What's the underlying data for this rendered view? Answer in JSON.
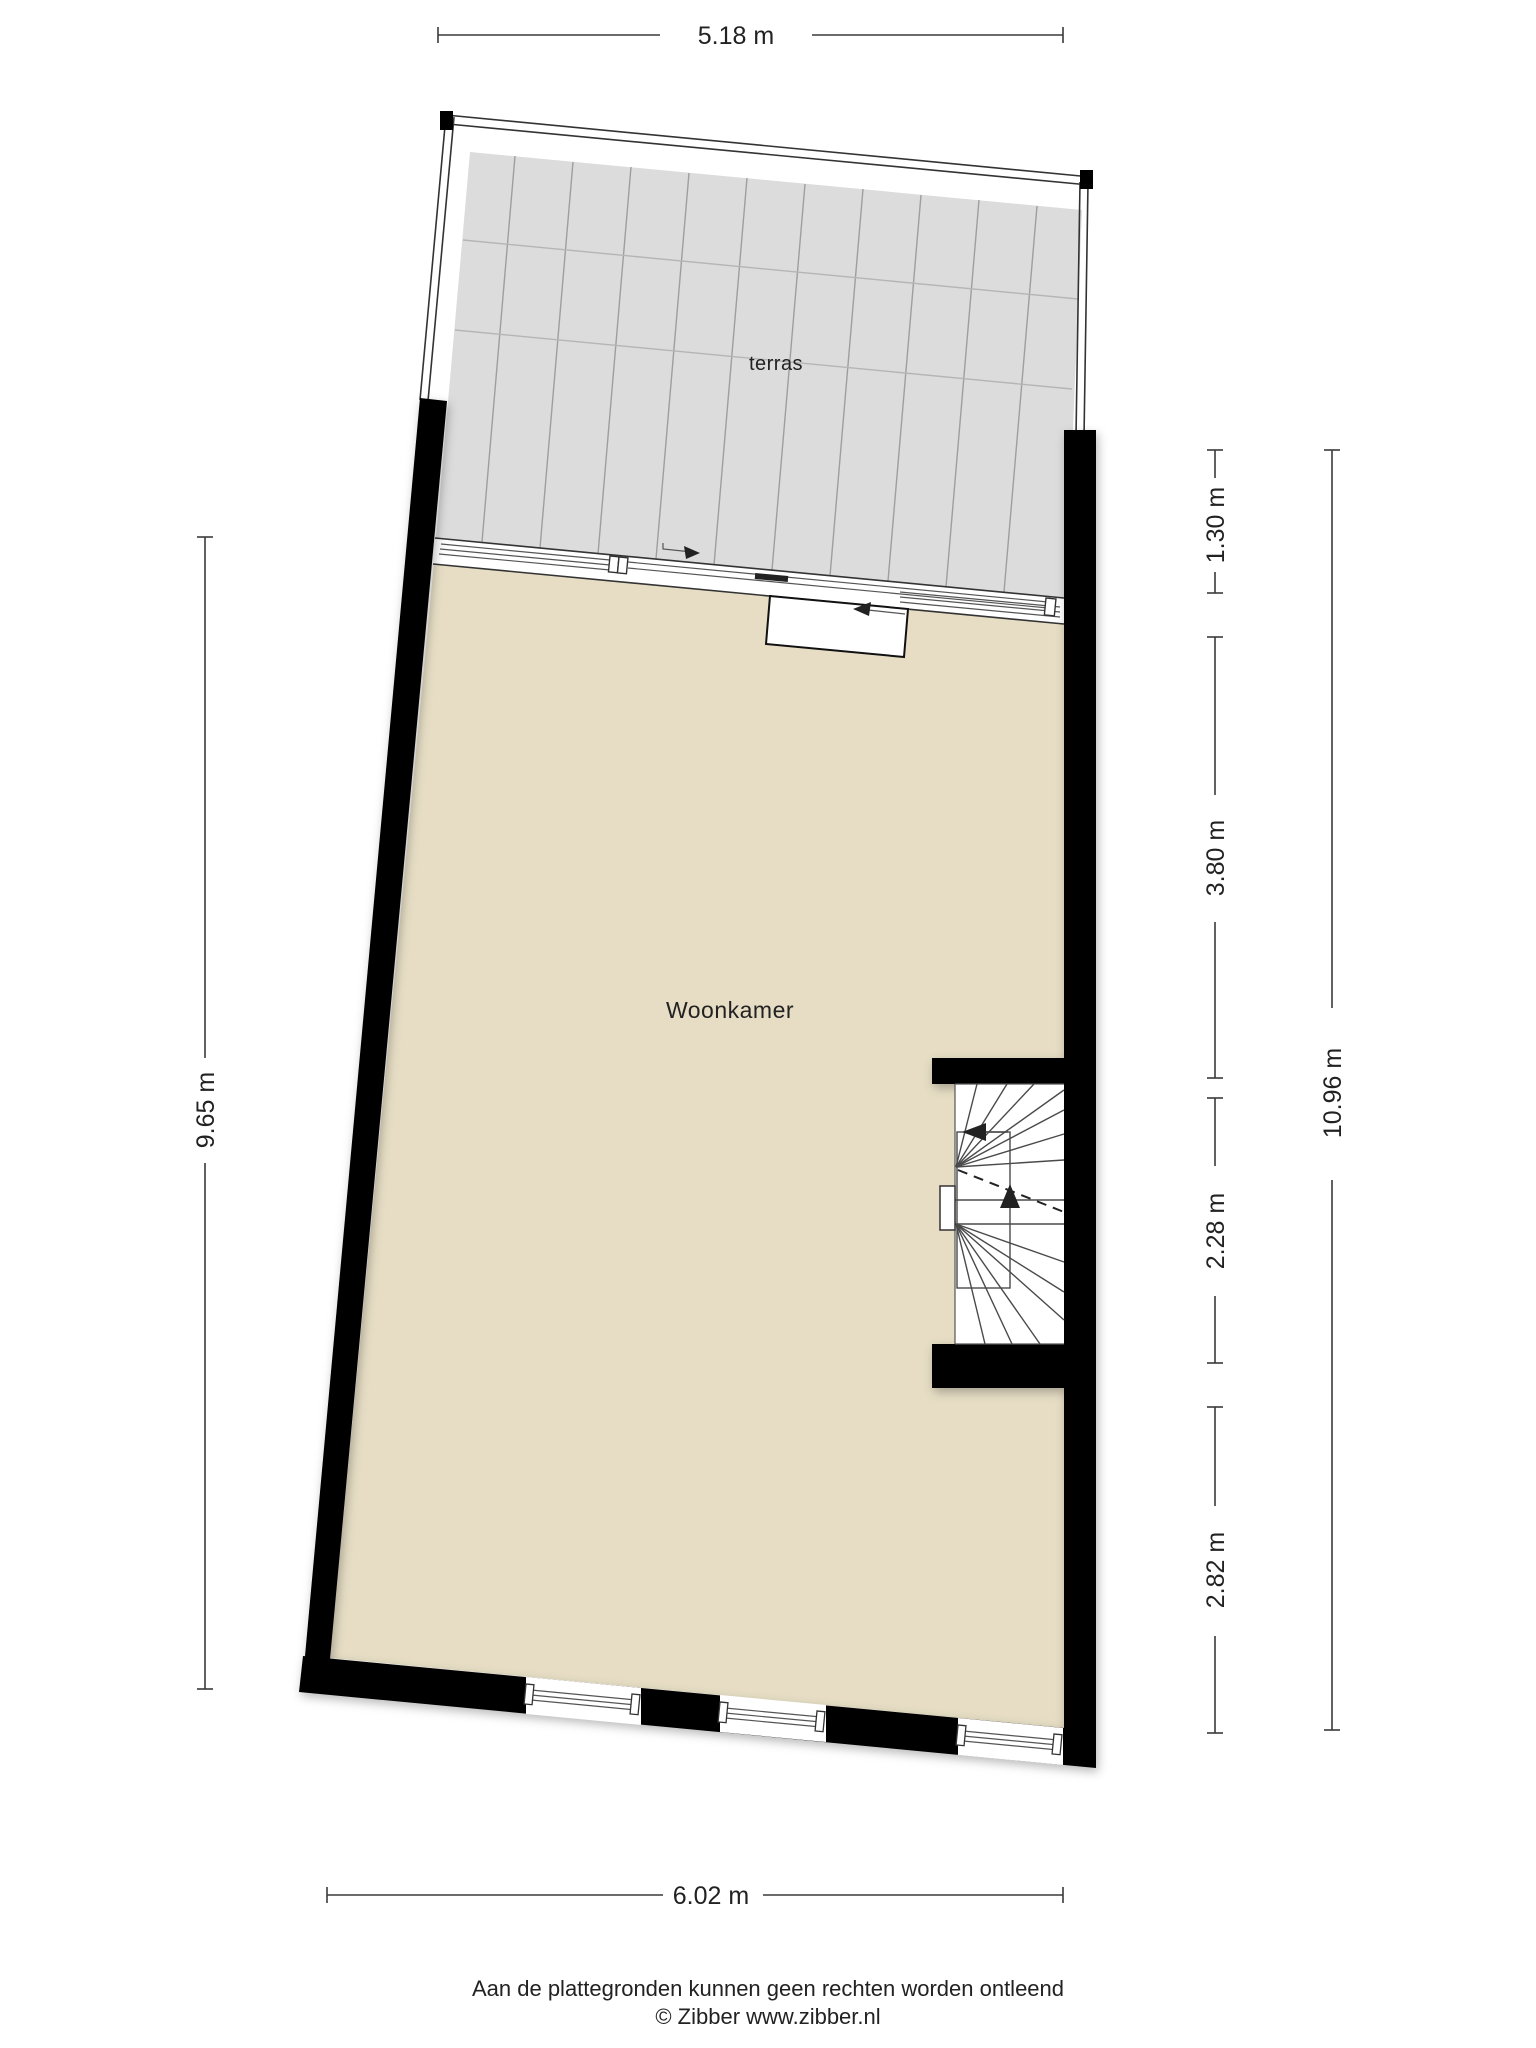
{
  "plan": {
    "labels": {
      "terrace": "terras",
      "living_room": "Woonkamer"
    },
    "dimensions": {
      "top": "5.18 m",
      "left": "9.65 m",
      "bottom": "6.02 m",
      "right_total": "10.96 m",
      "right_segments": [
        "1.30 m",
        "3.80 m",
        "2.28 m",
        "2.82 m"
      ]
    },
    "footer": {
      "disclaimer": "Aan de plattegronden kunnen geen rechten worden ontleend",
      "copyright": "© Zibber www.zibber.nl"
    },
    "colors": {
      "floor": "#e6ddc4",
      "deck": "#dcdcdc",
      "wall": "#000000",
      "dimension_line": "#3a3a3a"
    }
  }
}
